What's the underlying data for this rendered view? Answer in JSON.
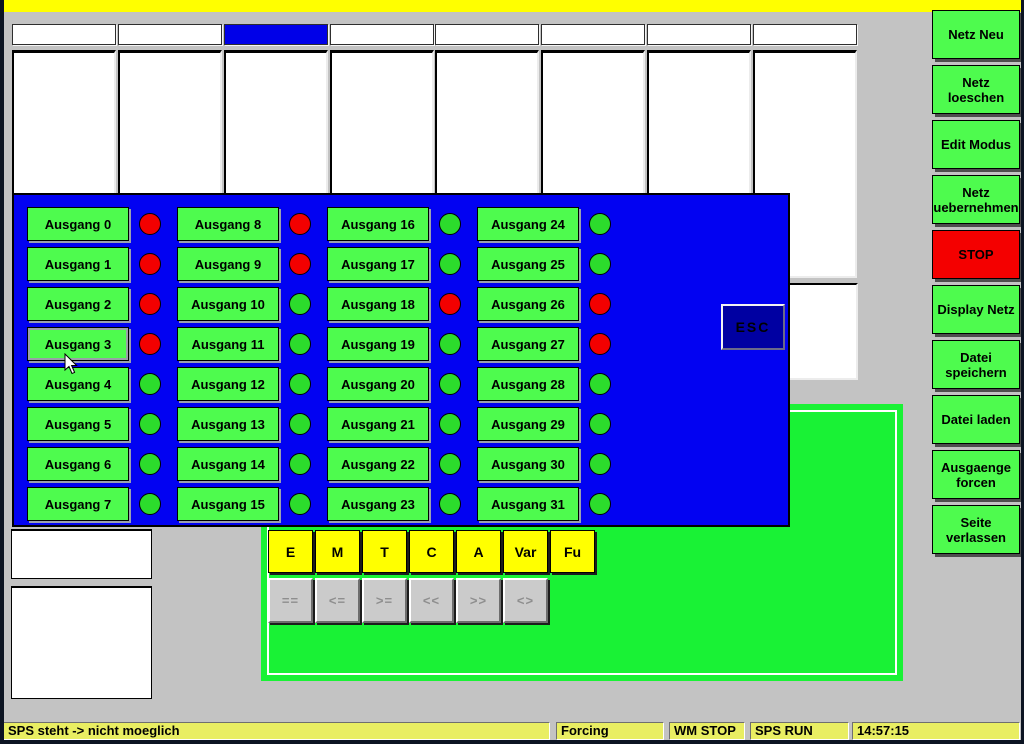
{
  "colors": {
    "led_on": "#2cdc2c",
    "led_off": "#f30000",
    "dialog_blue": "#0202f2",
    "panel_green": "#19f235",
    "button_green": "#4efb4e",
    "stop_red": "#f40000",
    "selected_tab_blue": "#0000e8",
    "titlebar_yellow": "#ffff00",
    "status_yellow": "#e9ee62"
  },
  "tabs": {
    "items": [
      "",
      "",
      "",
      "",
      "",
      "",
      "",
      ""
    ],
    "selected_index": 2
  },
  "sidebar": {
    "buttons": [
      {
        "label": "Netz Neu",
        "type": "normal"
      },
      {
        "label": "Netz loeschen",
        "type": "normal"
      },
      {
        "label": "Edit Modus",
        "type": "normal"
      },
      {
        "label": "Netz uebernehmen",
        "type": "normal"
      },
      {
        "label": "STOP",
        "type": "stop"
      },
      {
        "label": "Display Netz",
        "type": "normal"
      },
      {
        "label": "Datei speichern",
        "type": "normal"
      },
      {
        "label": "Datei laden",
        "type": "normal"
      },
      {
        "label": "Ausgaenge forcen",
        "type": "normal"
      },
      {
        "label": "Seite verlassen",
        "type": "normal"
      }
    ]
  },
  "dialog": {
    "esc_label": "ESC",
    "focused_index": 3,
    "outputs": [
      {
        "label": "Ausgang 0",
        "state": "red"
      },
      {
        "label": "Ausgang 1",
        "state": "red"
      },
      {
        "label": "Ausgang 2",
        "state": "red"
      },
      {
        "label": "Ausgang 3",
        "state": "red"
      },
      {
        "label": "Ausgang 4",
        "state": "green"
      },
      {
        "label": "Ausgang 5",
        "state": "green"
      },
      {
        "label": "Ausgang 6",
        "state": "green"
      },
      {
        "label": "Ausgang 7",
        "state": "green"
      },
      {
        "label": "Ausgang 8",
        "state": "red"
      },
      {
        "label": "Ausgang 9",
        "state": "red"
      },
      {
        "label": "Ausgang 10",
        "state": "green"
      },
      {
        "label": "Ausgang 11",
        "state": "green"
      },
      {
        "label": "Ausgang 12",
        "state": "green"
      },
      {
        "label": "Ausgang 13",
        "state": "green"
      },
      {
        "label": "Ausgang 14",
        "state": "green"
      },
      {
        "label": "Ausgang 15",
        "state": "green"
      },
      {
        "label": "Ausgang 16",
        "state": "green"
      },
      {
        "label": "Ausgang 17",
        "state": "green"
      },
      {
        "label": "Ausgang 18",
        "state": "red"
      },
      {
        "label": "Ausgang 19",
        "state": "green"
      },
      {
        "label": "Ausgang 20",
        "state": "green"
      },
      {
        "label": "Ausgang 21",
        "state": "green"
      },
      {
        "label": "Ausgang 22",
        "state": "green"
      },
      {
        "label": "Ausgang 23",
        "state": "green"
      },
      {
        "label": "Ausgang 24",
        "state": "green"
      },
      {
        "label": "Ausgang 25",
        "state": "green"
      },
      {
        "label": "Ausgang 26",
        "state": "red"
      },
      {
        "label": "Ausgang 27",
        "state": "red"
      },
      {
        "label": "Ausgang 28",
        "state": "green"
      },
      {
        "label": "Ausgang 29",
        "state": "green"
      },
      {
        "label": "Ausgang 30",
        "state": "green"
      },
      {
        "label": "Ausgang 31",
        "state": "green"
      }
    ]
  },
  "toolbar": {
    "type_buttons": [
      "E",
      "M",
      "T",
      "C",
      "A",
      "Var",
      "Fu"
    ],
    "operator_buttons": [
      "==",
      "<=",
      ">=",
      "<<",
      ">>",
      "<>"
    ]
  },
  "statusbar": {
    "segments": [
      "SPS steht -> nicht moeglich",
      "Forcing",
      "WM STOP",
      "SPS RUN",
      "14:57:15"
    ]
  }
}
